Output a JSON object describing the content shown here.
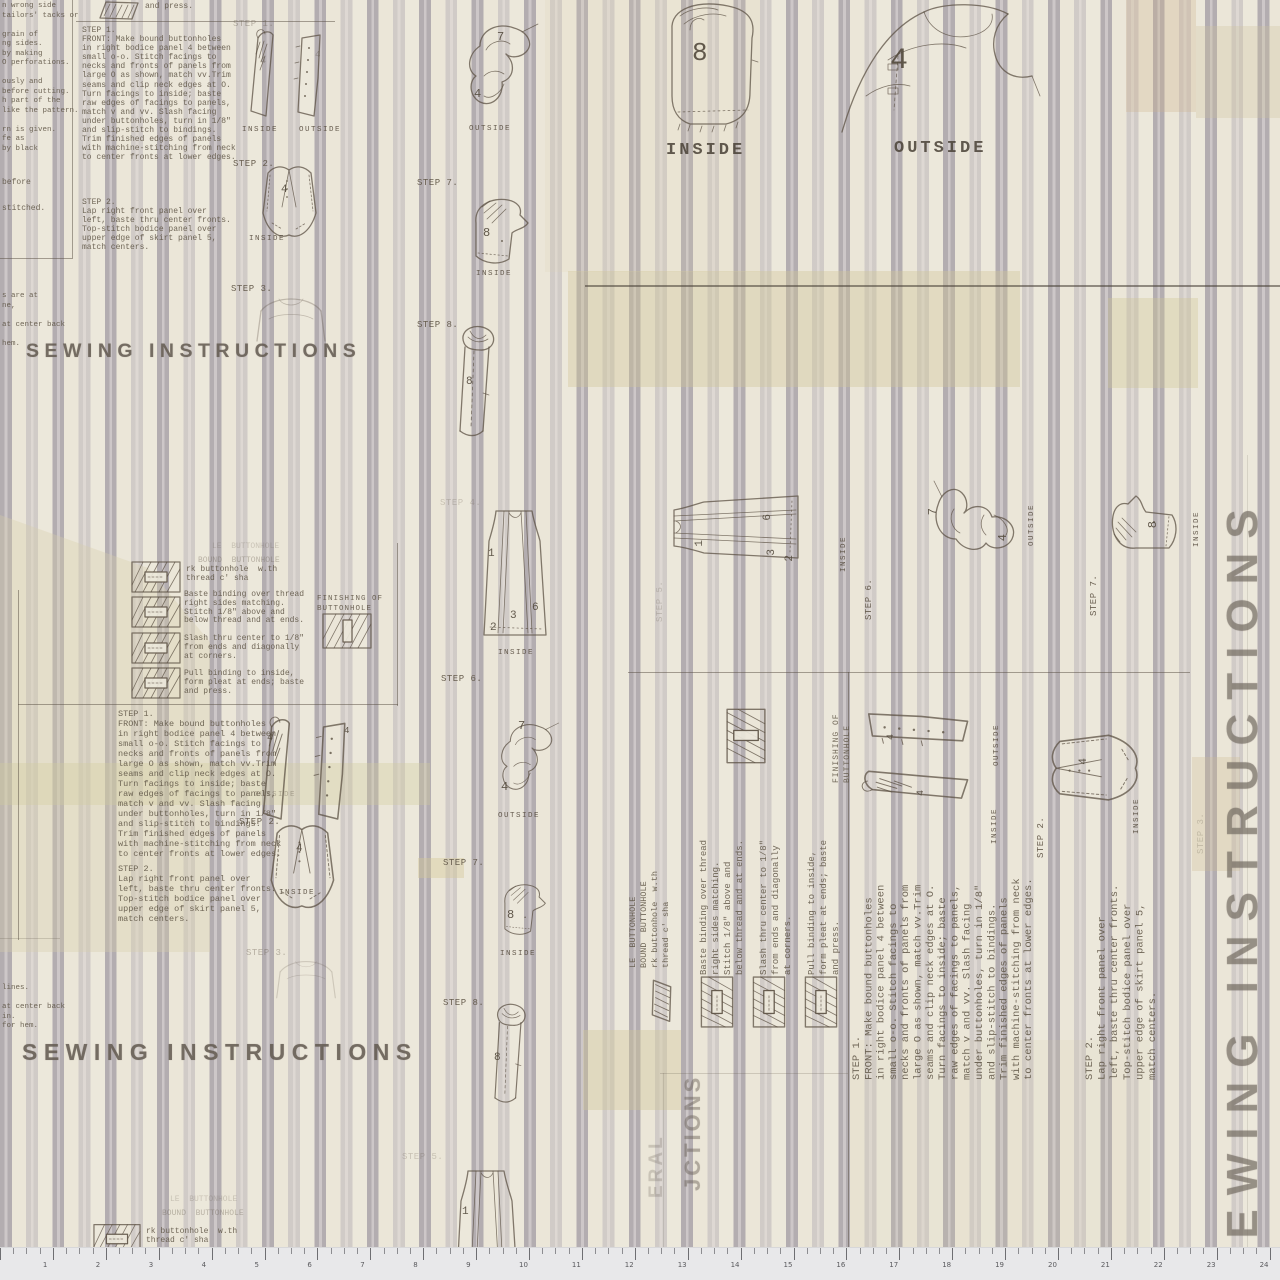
{
  "a": {
    "headline": "SEWING INSTRUCTIONS",
    "headline_fragment": "JCTIONS",
    "headline_fragment2": "ERAL",
    "labels": {
      "inside": "INSIDE",
      "outside": "OUTSIDE",
      "step1": "STEP 1.",
      "step2": "STEP 2.",
      "step3": "STEP 3.",
      "step4": "STEP 4.",
      "step5": "STEP 5.",
      "step6": "STEP 6.",
      "step7": "STEP 7.",
      "step8": "STEP 8.",
      "and_press": "and press."
    },
    "numbers": {
      "n1": "1",
      "n2": "2",
      "n3": "3",
      "n4": "4",
      "n6": "6",
      "n7": "7",
      "n8": "8"
    },
    "blocks": {
      "step1_text": [
        "STEP 1.",
        "FRONT: Make bound buttonholes",
        "in right bodice panel 4 between",
        "small o-o. Stitch facings to",
        "necks and fronts of panels from",
        "large O as shown, match vv.Trim",
        "seams and clip neck edges at O.",
        "Turn facings to inside; baste",
        "raw edges of facings to panels,",
        "match v and vv. Slash facing",
        "under buttonholes, turn in 1/8\"",
        "and slip-stitch to bindings.",
        "Trim finished edges of panels",
        "with machine-stitching from neck",
        "to center fronts at lower edges."
      ],
      "step2_text": [
        "STEP 2.",
        "Lap right front panel over",
        "left, baste thru center fronts.",
        "Top-stitch bodice panel over",
        "upper edge of skirt panel 5,",
        "match centers."
      ],
      "bound_header_top": "LE  BUTTONHOLE",
      "bound_header": "BOUND  BUTTONHOLE",
      "rot_header": [
        "LE  BUTTONHOLE",
        "BOUND  BUTTONHOLE",
        "rk buttonhole  w.th",
        "thread c' sha"
      ],
      "bh_intro": [
        "rk buttonhole  w.th",
        "thread c' sha"
      ],
      "bh_steps": [
        "Baste binding over thread",
        "right sides matching.",
        "Stitch 1/8\" above and",
        "below thread and at ends.",
        "",
        "Slash thru center to 1/8\"",
        "from ends and diagonally",
        "at corners.",
        "",
        "Pull binding to inside,",
        "form pleat at ends; baste",
        "and press."
      ],
      "finishing": [
        "FINISHING OF",
        "BUTTONHOLE"
      ],
      "margin_top": [
        "n wrong side",
        "tailors' tacks or",
        "",
        "grain of",
        "ng sides.",
        "by making",
        "O perforations.",
        "",
        "ously and",
        "before cutting.",
        "h part of the",
        "like the pattern.",
        "",
        "rn is given.",
        "fe as",
        "by black"
      ],
      "margin_mid": [
        "before",
        "",
        "stitched."
      ],
      "margin_low": [
        "s are at",
        "ne,",
        "",
        "at center back",
        "",
        "hem."
      ],
      "margin_low2": [
        "lines.",
        "",
        "at center back",
        "in.",
        "for hem."
      ]
    },
    "ruler": {
      "unit_px": 52.9,
      "numbers": [
        "1",
        "2",
        "3",
        "4",
        "5",
        "6",
        "7",
        "8",
        "9",
        "10",
        "11",
        "12",
        "13",
        "14",
        "15",
        "16",
        "17",
        "18",
        "19",
        "20",
        "21",
        "22",
        "23",
        "24"
      ]
    },
    "colors": {
      "cream": "#ebe6d8",
      "stripe_gray": "#b3adb0",
      "stripe_light": "#cdc7c8",
      "tape_olive": "#cfc696",
      "ink": "#5f574a",
      "ruler_bg": "#e8e8ea"
    }
  }
}
